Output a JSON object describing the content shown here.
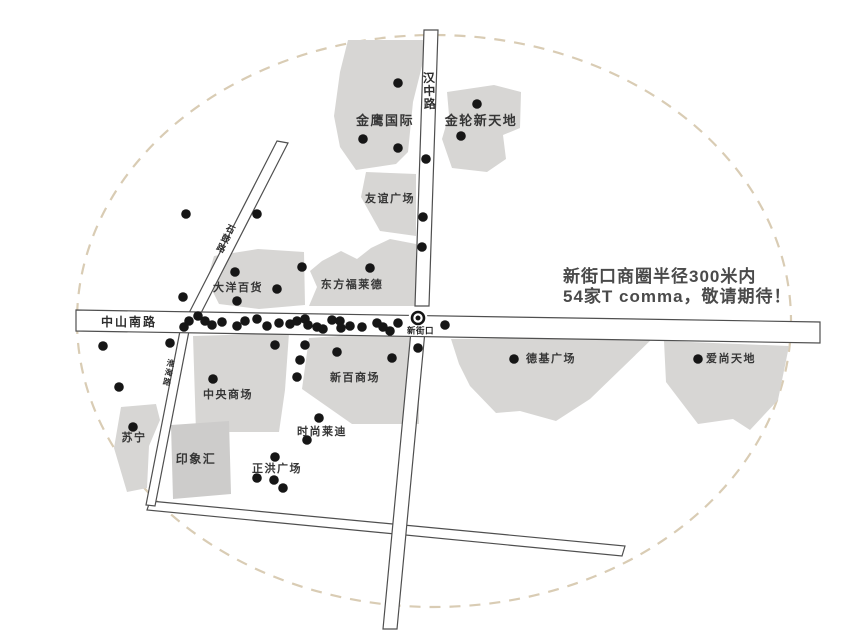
{
  "map": {
    "annotation": {
      "line1": "新街口商圈半径300米内",
      "line2": "54家T comma，敬请期待！"
    },
    "station": {
      "label": "新街口"
    },
    "colors": {
      "building": "#d7d6d4",
      "building_alt": "#cdcccb",
      "dot": "#161616",
      "road_stroke": "#4f4f4f",
      "road_fill": "#ffffff",
      "boundary": "#d9ccb4",
      "label": "#363636",
      "annotation": "#4a4a4a"
    },
    "roads": [
      {
        "id": "bottom-road",
        "pts": "150,501 625,546 622,556 147,510"
      },
      {
        "id": "huaihai-road",
        "pts": "180,331 189,331 155,506 146,505"
      },
      {
        "id": "shigu-road",
        "pts": "277,141 288,143 200,315 189,313"
      },
      {
        "id": "hanzhong-road-upper",
        "pts": "424,30 438,30 429,306 415,306"
      },
      {
        "id": "vertical-road-lower",
        "pts": "411,331 425,331 397,629 383,629"
      },
      {
        "id": "zhongshan-south-road",
        "pts": "76,310 820,322 820,343 76,331"
      }
    ],
    "road_labels": [
      {
        "id": "hanzhong-road-label",
        "text": "汉中路",
        "x": 429,
        "y": 82,
        "vertical": true,
        "rotate": -2,
        "fs": 12,
        "ch": 13
      },
      {
        "id": "zhongshan-south-road-label",
        "text": "中山南路",
        "x": 101,
        "y": 326,
        "vertical": false,
        "rotate": 0,
        "fs": 12,
        "ch": 0
      },
      {
        "id": "shigu-road-label",
        "text": "石鼓路",
        "x": 229,
        "y": 232,
        "vertical": true,
        "rotate": 26,
        "fs": 9,
        "ch": 10.5
      },
      {
        "id": "huaihai-road-label",
        "text": "淮海路",
        "x": 170,
        "y": 366,
        "vertical": true,
        "rotate": 11,
        "fs": 8,
        "ch": 9.5
      }
    ],
    "buildings": [
      {
        "id": "jinying-guoji",
        "label": "金鹰国际",
        "lx": 385,
        "ly": 125,
        "fs": 13,
        "alt": false,
        "pts": "348,40 424,40 424,58 413,102 408,152 396,164 356,170 340,147 334,116 340,72"
      },
      {
        "id": "jinlun-xintiandi",
        "label": "金轮新天地",
        "lx": 481,
        "ly": 125,
        "fs": 13,
        "alt": false,
        "pts": "447,92 494,85 521,92 520,128 503,135 506,159 487,172 452,168 442,139 449,115"
      },
      {
        "id": "youyi-guangchang",
        "label": "友谊广场",
        "lx": 390,
        "ly": 202,
        "fs": 11,
        "alt": false,
        "pts": "366,172 416,174 416,236 380,231 361,197"
      },
      {
        "id": "dayang-baihuo",
        "label": "大洋百货",
        "lx": 238,
        "ly": 291,
        "fs": 11,
        "alt": false,
        "pts": "214,256 258,249 304,252 305,305 259,309 219,304 207,280"
      },
      {
        "id": "dongfang-fulaide",
        "label": "东方福莱德",
        "lx": 352,
        "ly": 288,
        "fs": 11,
        "alt": false,
        "pts": "322,261 341,251 357,259 371,248 390,239 416,244 416,306 309,306 317,287 310,271"
      },
      {
        "id": "zhongyang-shangchang",
        "label": "中央商场",
        "lx": 228,
        "ly": 398,
        "fs": 11,
        "alt": false,
        "pts": "193,336 289,333 285,390 279,432 196,432"
      },
      {
        "id": "xinbai-shangchang",
        "label": "新百商场",
        "lx": 355,
        "ly": 381,
        "fs": 11,
        "alt": false,
        "pts": "309,338 368,334 419,337 419,424 352,424 302,389"
      },
      {
        "id": "deji-guangchang",
        "label": "德基广场",
        "lx": 551,
        "ly": 362,
        "fs": 11,
        "alt": false,
        "pts": "451,339 654,337 590,399 556,421 520,411 496,413 470,386 459,364"
      },
      {
        "id": "aishang-tiandi",
        "label": "爱尚天地",
        "lx": 731,
        "ly": 362,
        "fs": 11,
        "alt": false,
        "pts": "664,341 789,346 778,400 750,430 733,419 698,424 666,382"
      },
      {
        "id": "suning",
        "label": "苏宁",
        "lx": 134,
        "ly": 441,
        "fs": 11,
        "alt": false,
        "pts": "121,407 156,404 160,420 149,446 147,488 127,492 114,448"
      },
      {
        "id": "yinxiang-hui",
        "label": "印象汇",
        "lx": 196,
        "ly": 463,
        "fs": 12,
        "alt": true,
        "pts": "171,425 229,421 231,494 173,499"
      }
    ],
    "floating_labels": [
      {
        "id": "shishang-laidi",
        "text": "时尚莱迪",
        "x": 322,
        "y": 435,
        "fs": 11
      },
      {
        "id": "zhenghong-guangchang",
        "text": "正洪广场",
        "x": 277,
        "y": 472,
        "fs": 11
      }
    ],
    "dots": [
      [
        398,
        83
      ],
      [
        363,
        139
      ],
      [
        398,
        148
      ],
      [
        477,
        104
      ],
      [
        461,
        136
      ],
      [
        186,
        214
      ],
      [
        257,
        214
      ],
      [
        426,
        159
      ],
      [
        423,
        217
      ],
      [
        422,
        247
      ],
      [
        302,
        267
      ],
      [
        370,
        268
      ],
      [
        235,
        272
      ],
      [
        277,
        289
      ],
      [
        237,
        301
      ],
      [
        183,
        297
      ],
      [
        189,
        321
      ],
      [
        184,
        327
      ],
      [
        198,
        316
      ],
      [
        205,
        321
      ],
      [
        212,
        325
      ],
      [
        222,
        322
      ],
      [
        237,
        326
      ],
      [
        245,
        321
      ],
      [
        257,
        319
      ],
      [
        267,
        326
      ],
      [
        279,
        323
      ],
      [
        290,
        324
      ],
      [
        297,
        321
      ],
      [
        305,
        319
      ],
      [
        308,
        325
      ],
      [
        317,
        327
      ],
      [
        323,
        329
      ],
      [
        332,
        320
      ],
      [
        340,
        321
      ],
      [
        341,
        328
      ],
      [
        350,
        326
      ],
      [
        362,
        327
      ],
      [
        377,
        323
      ],
      [
        383,
        327
      ],
      [
        390,
        331
      ],
      [
        398,
        323
      ],
      [
        445,
        325
      ],
      [
        275,
        345
      ],
      [
        305,
        345
      ],
      [
        300,
        360
      ],
      [
        297,
        377
      ],
      [
        337,
        352
      ],
      [
        392,
        358
      ],
      [
        418,
        348
      ],
      [
        213,
        379
      ],
      [
        103,
        346
      ],
      [
        170,
        343
      ],
      [
        119,
        387
      ],
      [
        514,
        359
      ],
      [
        698,
        359
      ],
      [
        133,
        427
      ],
      [
        319,
        418
      ],
      [
        307,
        440
      ],
      [
        275,
        457
      ],
      [
        257,
        478
      ],
      [
        274,
        480
      ],
      [
        283,
        488
      ]
    ]
  }
}
